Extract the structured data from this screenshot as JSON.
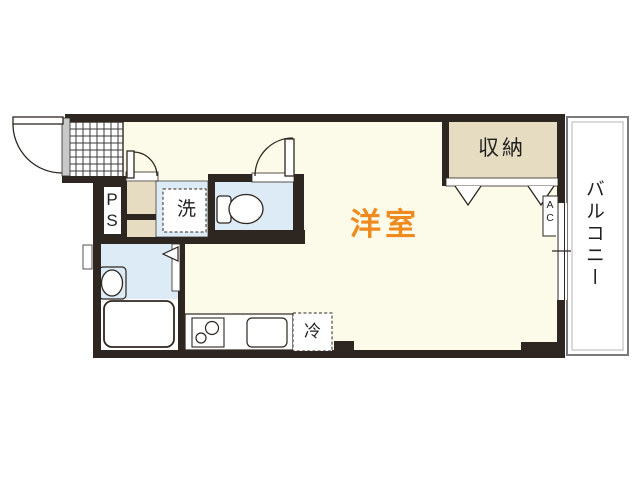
{
  "labels": {
    "main_room": "洋室",
    "closet": "収納",
    "balcony": "バルコニー",
    "pipe_space": "PS",
    "washing_machine": "洗",
    "refrigerator": "冷",
    "air_conditioner": "AC"
  },
  "colors": {
    "wall": "#2e2620",
    "floor": "#fcfae9",
    "closet_floor": "#e5dcc1",
    "wet_area_floor": "#dcebf5",
    "room_label": "#ee8a1e",
    "label_text": "#1f1f1f",
    "balcony_border": "#7a7a7a",
    "entry_tile_line": "#3b3b3b",
    "door_jamb": "#c9c9c9"
  }
}
